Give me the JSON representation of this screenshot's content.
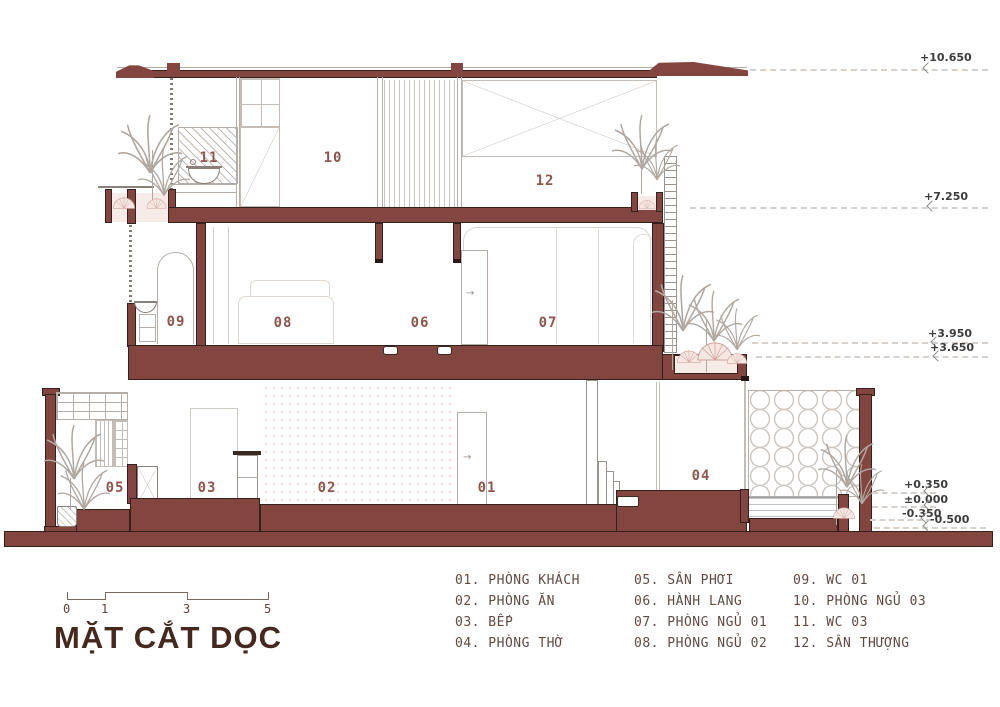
{
  "title_block": {
    "title": "MẶT CẮT DỌC",
    "scale_ticks": [
      "0",
      "1",
      "3",
      "5"
    ]
  },
  "rooms": [
    "01",
    "02",
    "03",
    "04",
    "05",
    "06",
    "07",
    "08",
    "09",
    "10",
    "11",
    "12"
  ],
  "elevations": [
    "+10.650",
    "+7.250",
    "+3.950",
    "+3.650",
    "+0.350",
    "±0.000",
    "-0.350",
    "-0.500"
  ],
  "legend": {
    "columns": [
      [
        "01. PHÒNG KHÁCH",
        "02. PHÒNG ĂN",
        "03. BẾP",
        "04. PHÒNG THỜ"
      ],
      [
        "05. SÂN PHƠI",
        "06. HÀNH LANG",
        "07. PHÒNG NGỦ 01",
        "08. PHÒNG NGỦ 02"
      ],
      [
        "09. WC 01",
        "10. PHÒNG NGỦ 03",
        "11. WC 03",
        "12. SÂN THƯỢNG"
      ]
    ]
  },
  "colors": {
    "wall": "#82453f",
    "outline": "#36201b",
    "room_label": "#8e564c",
    "legend_text": "#5f4b43",
    "title": "#46291e",
    "plant_pink": "#f7ebe7"
  }
}
